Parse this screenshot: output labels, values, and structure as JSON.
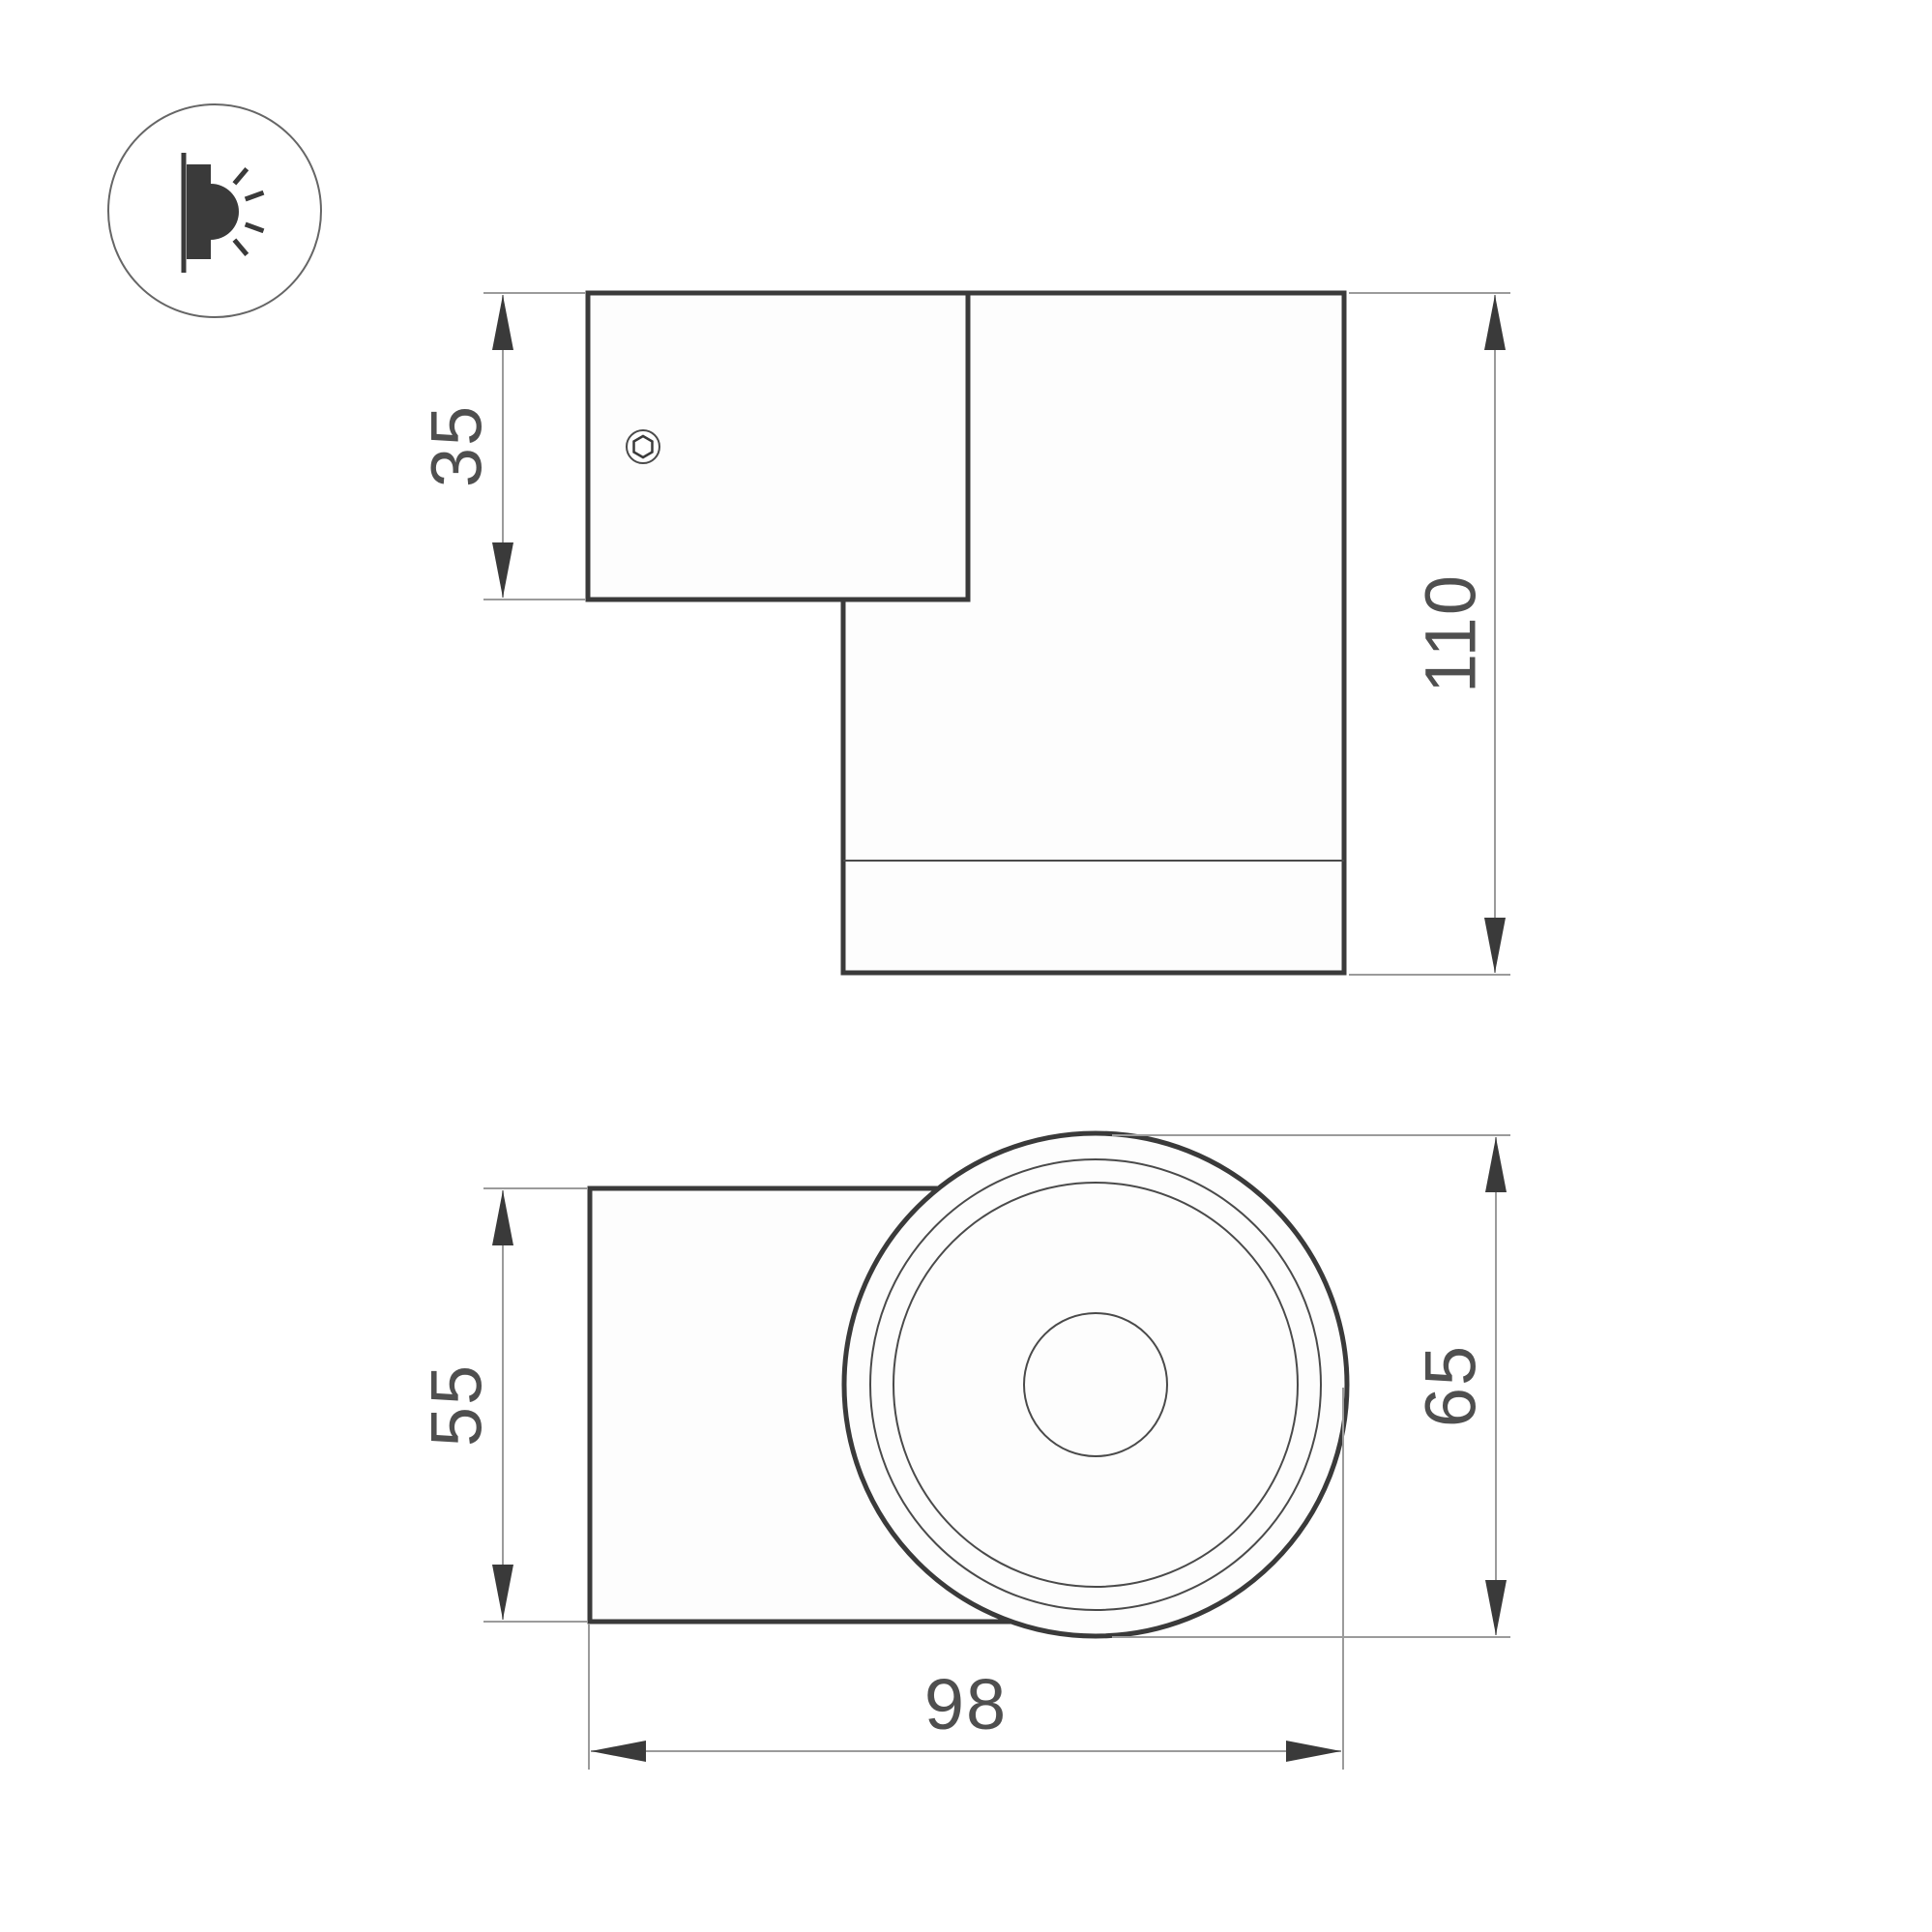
{
  "drawing": {
    "type_icon": "wall-mounted-light-side-beam",
    "side_view": {
      "plate_height": "35",
      "body_height": "110"
    },
    "front_view": {
      "body_width": "55",
      "diameter": "65",
      "overall_width": "98"
    }
  },
  "theme": {
    "outline": "#3a3a3a",
    "thin": "#4a4a4a",
    "dim": "#9b9b9b",
    "text": "#4f4f4f",
    "face": "#fdfdfd",
    "background": "#ffffff"
  }
}
